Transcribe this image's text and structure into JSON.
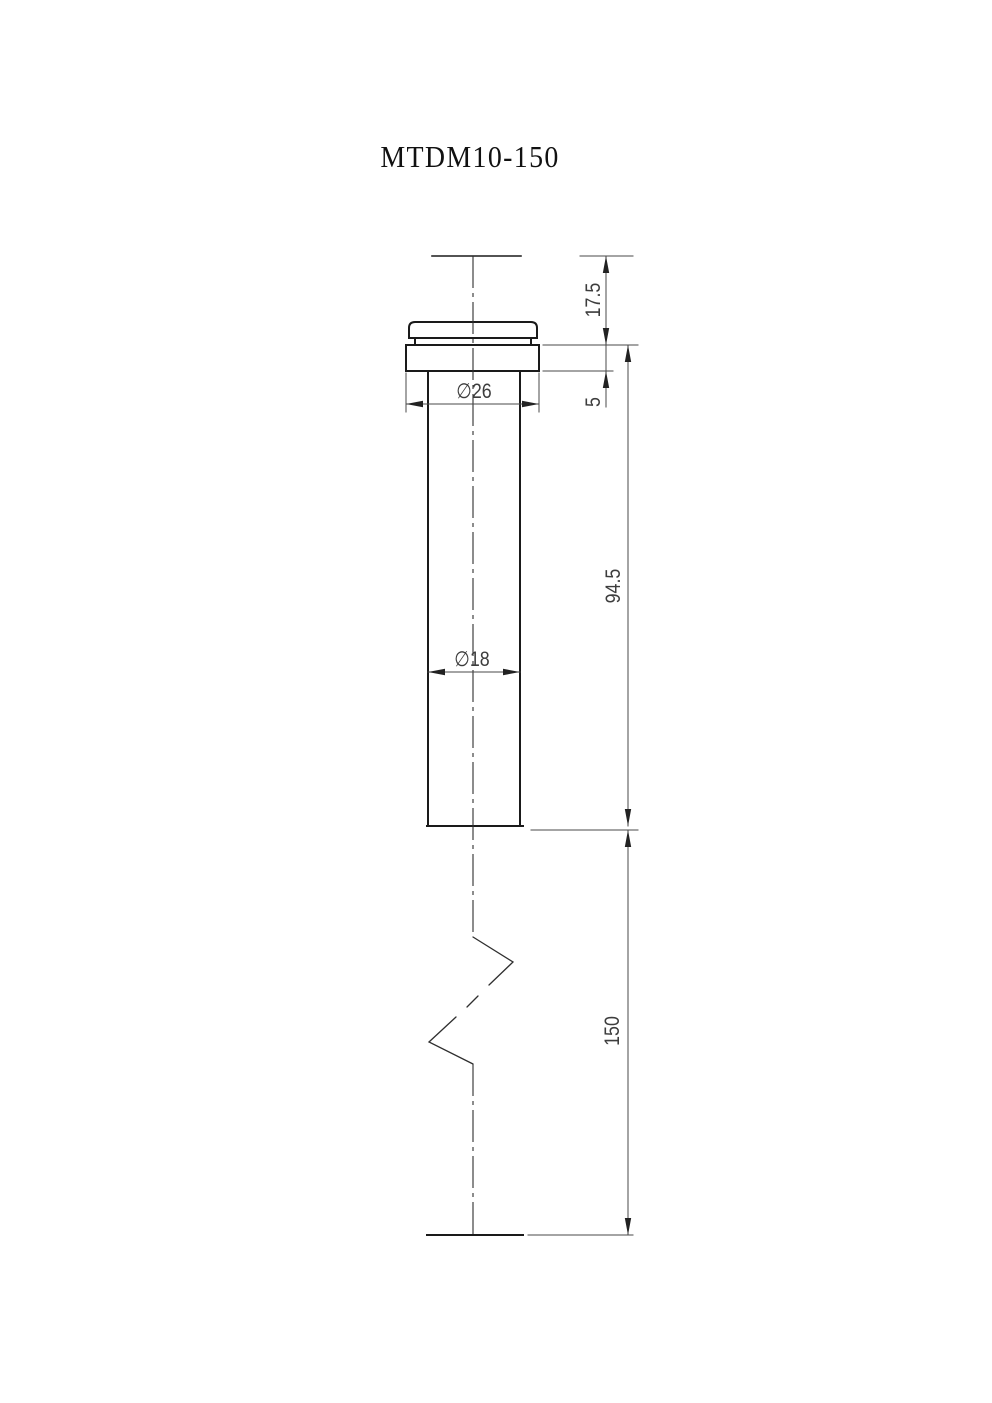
{
  "title": "MTDM10-150",
  "dimensions": {
    "cap_height": "17.5",
    "flange_thickness": "5",
    "body_length": "94.5",
    "shank_length": "150",
    "flange_diameter": "∅26",
    "body_diameter": "∅18"
  },
  "colors": {
    "background": "#ffffff",
    "outline": "#1a1a1a",
    "thin_line": "#4a4a4a",
    "break_line": "#2f2f2f",
    "arrow": "#222222",
    "dim_text": "#3d3d3d",
    "title_text": "#111111"
  }
}
